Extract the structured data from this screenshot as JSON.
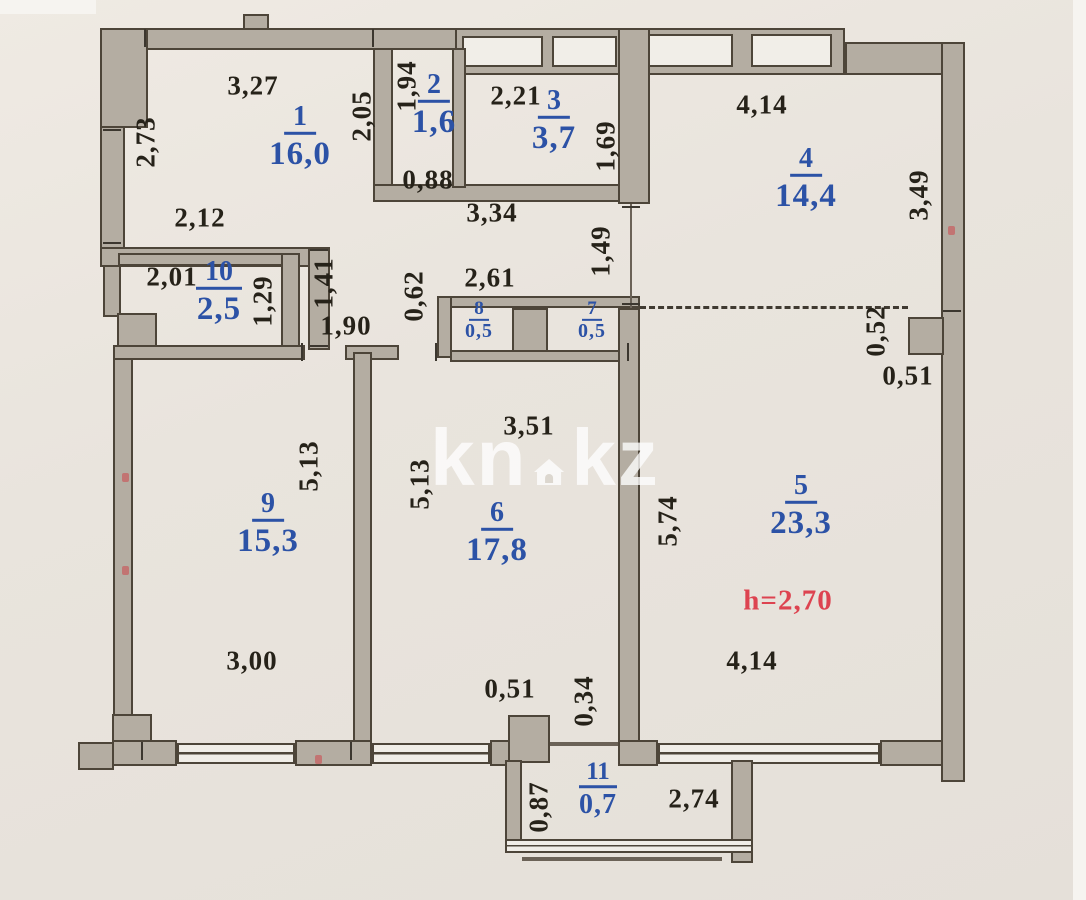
{
  "plan": {
    "watermark": {
      "left": "kn",
      "right": "kz"
    },
    "red_label": {
      "text": "h=2,70",
      "x": 788,
      "y": 601
    },
    "rooms": [
      {
        "number": "1",
        "area": "16,0",
        "x": 300,
        "y": 120,
        "size": "lg"
      },
      {
        "number": "2",
        "area": "1,6",
        "x": 434,
        "y": 88,
        "size": "lg"
      },
      {
        "number": "3",
        "area": "3,7",
        "x": 554,
        "y": 104,
        "size": "lg"
      },
      {
        "number": "4",
        "area": "14,4",
        "x": 806,
        "y": 162,
        "size": "lg"
      },
      {
        "number": "5",
        "area": "23,3",
        "x": 801,
        "y": 489,
        "size": "lg"
      },
      {
        "number": "6",
        "area": "17,8",
        "x": 497,
        "y": 516,
        "size": "lg"
      },
      {
        "number": "7",
        "area": "0,5",
        "x": 592,
        "y": 310,
        "size": "sm"
      },
      {
        "number": "8",
        "area": "0,5",
        "x": 479,
        "y": 310,
        "size": "sm"
      },
      {
        "number": "9",
        "area": "15,3",
        "x": 268,
        "y": 507,
        "size": "lg"
      },
      {
        "number": "10",
        "area": "2,5",
        "x": 219,
        "y": 275,
        "size": "lg"
      },
      {
        "number": "11",
        "area": "0,7",
        "x": 598,
        "y": 775,
        "size": "md"
      }
    ],
    "dimensions": [
      {
        "v": "3,27",
        "x": 253,
        "y": 86,
        "r": 0
      },
      {
        "v": "2,73",
        "x": 146,
        "y": 142,
        "r": 1
      },
      {
        "v": "2,05",
        "x": 362,
        "y": 116,
        "r": 1
      },
      {
        "v": "1,94",
        "x": 407,
        "y": 86,
        "r": 1
      },
      {
        "v": "2,12",
        "x": 200,
        "y": 218,
        "r": 0
      },
      {
        "v": "0,88",
        "x": 428,
        "y": 180,
        "r": 0
      },
      {
        "v": "2,21",
        "x": 516,
        "y": 96,
        "r": 0
      },
      {
        "v": "1,69",
        "x": 606,
        "y": 146,
        "r": 1
      },
      {
        "v": "4,14",
        "x": 762,
        "y": 105,
        "r": 0
      },
      {
        "v": "3,49",
        "x": 919,
        "y": 195,
        "r": 1
      },
      {
        "v": "3,34",
        "x": 492,
        "y": 213,
        "r": 0
      },
      {
        "v": "1,49",
        "x": 601,
        "y": 251,
        "r": 1
      },
      {
        "v": "2,61",
        "x": 490,
        "y": 278,
        "r": 0
      },
      {
        "v": "0,62",
        "x": 414,
        "y": 296,
        "r": 1
      },
      {
        "v": "2,01",
        "x": 172,
        "y": 277,
        "r": 0
      },
      {
        "v": "1,29",
        "x": 263,
        "y": 301,
        "r": 1
      },
      {
        "v": "1,41",
        "x": 324,
        "y": 283,
        "r": 1
      },
      {
        "v": "1,90",
        "x": 346,
        "y": 326,
        "r": 0
      },
      {
        "v": "5,13",
        "x": 309,
        "y": 466,
        "r": 1
      },
      {
        "v": "5,13",
        "x": 420,
        "y": 484,
        "r": 1
      },
      {
        "v": "3,51",
        "x": 529,
        "y": 426,
        "r": 0
      },
      {
        "v": "5,74",
        "x": 668,
        "y": 521,
        "r": 1
      },
      {
        "v": "3,00",
        "x": 252,
        "y": 661,
        "r": 0
      },
      {
        "v": "0,51",
        "x": 510,
        "y": 689,
        "r": 0
      },
      {
        "v": "0,34",
        "x": 584,
        "y": 701,
        "r": 1
      },
      {
        "v": "4,14",
        "x": 752,
        "y": 661,
        "r": 0
      },
      {
        "v": "0,52",
        "x": 876,
        "y": 331,
        "r": 1
      },
      {
        "v": "0,51",
        "x": 908,
        "y": 376,
        "r": 0
      },
      {
        "v": "0,87",
        "x": 539,
        "y": 807,
        "r": 1
      },
      {
        "v": "2,74",
        "x": 694,
        "y": 799,
        "r": 0
      }
    ],
    "ticks": [
      {
        "x": 145,
        "y": 38,
        "o": "v"
      },
      {
        "x": 373,
        "y": 38,
        "o": "v"
      },
      {
        "x": 112,
        "y": 130,
        "o": "h"
      },
      {
        "x": 112,
        "y": 243,
        "o": "h"
      },
      {
        "x": 319,
        "y": 250,
        "o": "h"
      },
      {
        "x": 319,
        "y": 346,
        "o": "h"
      },
      {
        "x": 631,
        "y": 207,
        "o": "h"
      },
      {
        "x": 631,
        "y": 304,
        "o": "h"
      },
      {
        "x": 302,
        "y": 352,
        "o": "v"
      },
      {
        "x": 436,
        "y": 352,
        "o": "v"
      },
      {
        "x": 952,
        "y": 311,
        "o": "h"
      },
      {
        "x": 142,
        "y": 751,
        "o": "v"
      },
      {
        "x": 351,
        "y": 751,
        "o": "v"
      },
      {
        "x": 628,
        "y": 352,
        "o": "v"
      }
    ],
    "red_marks": [
      {
        "x": 122,
        "y": 473
      },
      {
        "x": 122,
        "y": 566
      },
      {
        "x": 948,
        "y": 226
      },
      {
        "x": 315,
        "y": 755
      }
    ]
  }
}
